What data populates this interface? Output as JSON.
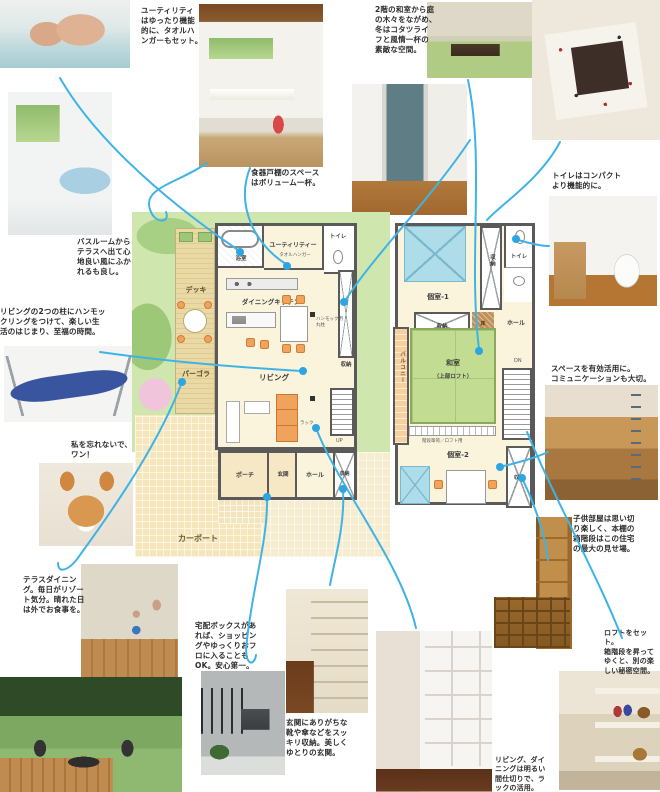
{
  "colors": {
    "annotation_line": "#3fb3e6",
    "plan_wall": "#5a5a5a",
    "plan_floor": "#fbf4dd",
    "garden_green": "#cfe7ae",
    "tatami_green": "#c2dc92",
    "deck_tan": "#ead9a4",
    "carport_beige": "#f6e6bc",
    "furniture_orange": "#f0a35c",
    "bed_blue": "#aedce9"
  },
  "captions": {
    "utility": "ユーティリティ\nはゆったり機能\n的に、タオルハ\nンガーもセット。",
    "tatami": "2階の和室から庭\nの木々をながめ、\n冬はコタツライ\nフと風情一杯の\n素敵な空間。",
    "cupboard": "食器戸棚のスペース\nはボリューム一杯。",
    "toilet": "トイレはコンパクト\nより機能的に。",
    "bathroom": "バスルームから\nテラスへ出て心\n地良い風にふか\nれるも良し。",
    "hammock": "リビングの2つの柱にハンモッ\nクリングをつけて、楽しい生\n活のはじまり、至福の時間。",
    "dog": "私を忘れないで、\nワン！",
    "bunk": "スペースを有効活用に。\nコミュニケーションも大切。",
    "kids": "子供部屋は思い切\nり楽しく、本棚の\n箱階段はこの住宅\nの最大の見せ場。",
    "terrace": "テラスダイニン\nグ。毎日がリゾー\nト気分。晴れた日\nは外でお食事を。",
    "delivery": "宅配ボックスがあ\nれば、ショッピン\nグやゆっくりおフ\nロに入ることも\nOK。安心第一。",
    "shoes": "玄関にありがちな\n靴や傘などをスッ\nキリ収納。美しく\nゆとりの玄関。",
    "loft": "ロフトをセット。\n箱階段を昇って\nゆくと、別の楽\nしい秘密空間。",
    "divider": "リビング、ダイ\nニングは明るい\n間仕切りで、ラ\nックの活用。"
  },
  "floor1": {
    "bath": "浴室",
    "utility": "ユーティリティー",
    "utility_note": "タオルハンガー",
    "toilet": "トイレ",
    "dk": "ダイニングキッチン",
    "deck": "デッキ",
    "pergola": "パーゴラ",
    "living": "リビング",
    "storage_right": "収納",
    "rack": "ラック",
    "stairs": "UP",
    "carport": "カーポート",
    "porch": "ポーチ",
    "entrance": "玄関",
    "hall": "ホール",
    "storage_bottom": "収納",
    "pillar_note": "ハンモック用\n丸柱"
  },
  "floor2": {
    "room1": "個室-1",
    "closet_top": "収納",
    "toilet": "トイレ",
    "hall": "ホール",
    "closet_mid": "収納",
    "floor_alcove": "床",
    "balcony": "バルコニー",
    "washitsu": "和室",
    "loft_note": "（上部ロフト）",
    "stair_note": "階段箪笥／ロフト用",
    "stairs": "DN",
    "room2": "個室-2",
    "closet_bottom": "収納"
  }
}
